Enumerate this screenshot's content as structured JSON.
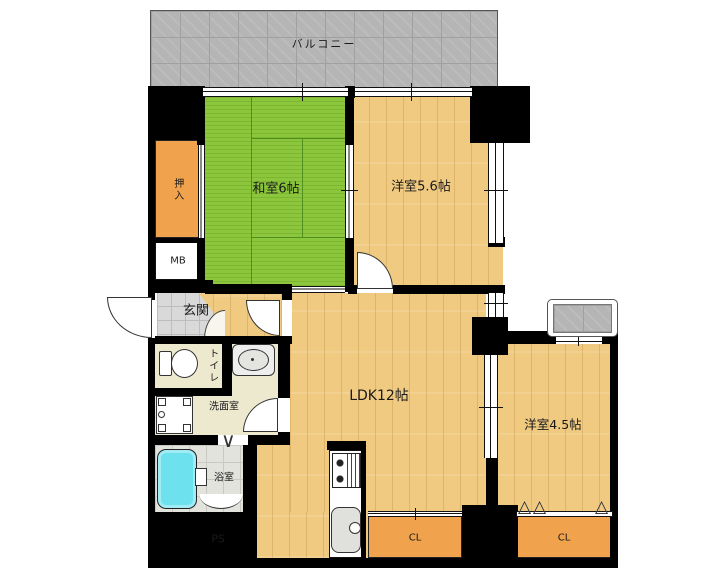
{
  "plan": {
    "type": "floorplan",
    "rooms": {
      "balcony": "バルコニー",
      "washitsu": "和室6帖",
      "yoshitsu56": "洋室5.6帖",
      "oshiire": "押入",
      "mb": "MB",
      "genkan": "玄関",
      "toilet": "トイレ",
      "senmen": "洗面室",
      "yokushitsu": "浴室",
      "ps": "PS",
      "ldk": "LDK12帖",
      "yoshitsu45": "洋室4.5帖",
      "cl_ldk": "CL",
      "cl_bedroom": "CL"
    },
    "icons": {
      "fold_door": "∨",
      "closet_door": "△"
    },
    "colors": {
      "wall": "#000000",
      "wood_floor": "#F0CA80",
      "tatami": "#8CC63C",
      "closet_orange": "#F1A24C",
      "washroom_cream": "#ECE9CF",
      "entry_tile": "#D9D9D9",
      "balcony_gray": "#B5B5B5",
      "bathtub_cyan": "#6EE1EF"
    }
  }
}
